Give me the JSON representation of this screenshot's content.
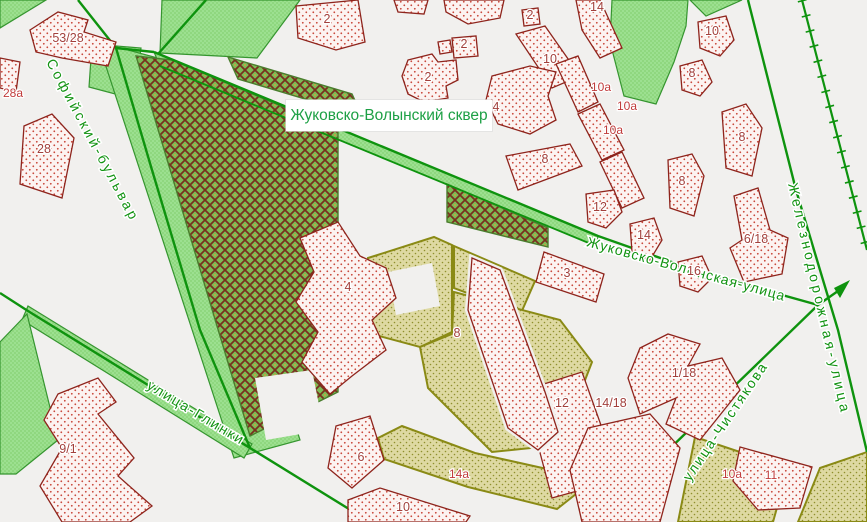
{
  "map": {
    "background": "#f1f0ee",
    "colors": {
      "road": "#0e930e",
      "street_label": "#129312",
      "building_outline": "#8e241c",
      "building_dot": "#c8473a",
      "building_number": "#a2403c",
      "address_number": "#c03b3b",
      "green_area_fill": "#8fd77f",
      "green_area_border": "#35952f",
      "park_hatch_green": "#7cbb55",
      "park_hatch_lattice": "#79301f",
      "olive_fill": "#ded9a2",
      "olive_border": "#8a8a15",
      "park_label_color": "#1da045"
    },
    "park_label": {
      "text": "Жуковско-Волынский сквер"
    },
    "streets": [
      {
        "name": "Софийский-бульвар",
        "x": 46,
        "y": 62,
        "rotate": 62,
        "ls": 3
      },
      {
        "name": "улица-Глинки",
        "x": 146,
        "y": 388,
        "rotate": 31,
        "ls": 2
      },
      {
        "name": "Жуковско-Волынская-улица",
        "x": 586,
        "y": 246,
        "rotate": 15.5,
        "ls": 1
      },
      {
        "name": "улица-Чистякова",
        "x": 690,
        "y": 482,
        "rotate": -56,
        "ls": 2
      },
      {
        "name": "Железнодорожная-улица",
        "x": 788,
        "y": 184,
        "rotate": 77,
        "ls": 3.5
      }
    ],
    "building_labels": [
      {
        "text": "53/28",
        "x": 68,
        "y": 42,
        "kind": "num"
      },
      {
        "text": "28а",
        "x": 13,
        "y": 97,
        "kind": "addr"
      },
      {
        "text": "28",
        "x": 44,
        "y": 153,
        "kind": "num"
      },
      {
        "text": "9/1",
        "x": 68,
        "y": 453,
        "kind": "num"
      },
      {
        "text": "2",
        "x": 327,
        "y": 23,
        "kind": "num"
      },
      {
        "text": "2",
        "x": 428,
        "y": 81,
        "kind": "num"
      },
      {
        "text": "2",
        "x": 464,
        "y": 48,
        "kind": "num"
      },
      {
        "text": "2",
        "x": 530,
        "y": 19,
        "kind": "num"
      },
      {
        "text": "10",
        "x": 550,
        "y": 63,
        "kind": "num"
      },
      {
        "text": "14",
        "x": 597,
        "y": 11,
        "kind": "num"
      },
      {
        "text": "10а",
        "x": 601,
        "y": 91,
        "kind": "addr"
      },
      {
        "text": "10а",
        "x": 627,
        "y": 110,
        "kind": "addr"
      },
      {
        "text": "10а",
        "x": 613,
        "y": 134,
        "kind": "addr"
      },
      {
        "text": "4",
        "x": 496,
        "y": 111,
        "kind": "num"
      },
      {
        "text": "8",
        "x": 545,
        "y": 163,
        "kind": "num"
      },
      {
        "text": "12",
        "x": 600,
        "y": 211,
        "kind": "num"
      },
      {
        "text": "14",
        "x": 644,
        "y": 239,
        "kind": "num"
      },
      {
        "text": "16",
        "x": 694,
        "y": 275,
        "kind": "num"
      },
      {
        "text": "6/18",
        "x": 756,
        "y": 243,
        "kind": "num"
      },
      {
        "text": "3",
        "x": 567,
        "y": 277,
        "kind": "num"
      },
      {
        "text": "8",
        "x": 742,
        "y": 141,
        "kind": "num"
      },
      {
        "text": "8",
        "x": 682,
        "y": 185,
        "kind": "num"
      },
      {
        "text": "10",
        "x": 712,
        "y": 35,
        "kind": "num"
      },
      {
        "text": "8",
        "x": 692,
        "y": 77,
        "kind": "num"
      },
      {
        "text": "4",
        "x": 348,
        "y": 291,
        "kind": "num"
      },
      {
        "text": "8",
        "x": 457,
        "y": 337,
        "kind": "num"
      },
      {
        "text": "6",
        "x": 361,
        "y": 461,
        "kind": "num"
      },
      {
        "text": "10",
        "x": 403,
        "y": 511,
        "kind": "num"
      },
      {
        "text": "12",
        "x": 562,
        "y": 407,
        "kind": "num"
      },
      {
        "text": "14/18",
        "x": 611,
        "y": 407,
        "kind": "num"
      },
      {
        "text": "1/18",
        "x": 684,
        "y": 377,
        "kind": "num"
      },
      {
        "text": "11",
        "x": 771,
        "y": 479,
        "kind": "addr"
      },
      {
        "text": "10а",
        "x": 732,
        "y": 478,
        "kind": "addr"
      },
      {
        "text": "14а",
        "x": 459,
        "y": 478,
        "kind": "addr"
      }
    ]
  }
}
